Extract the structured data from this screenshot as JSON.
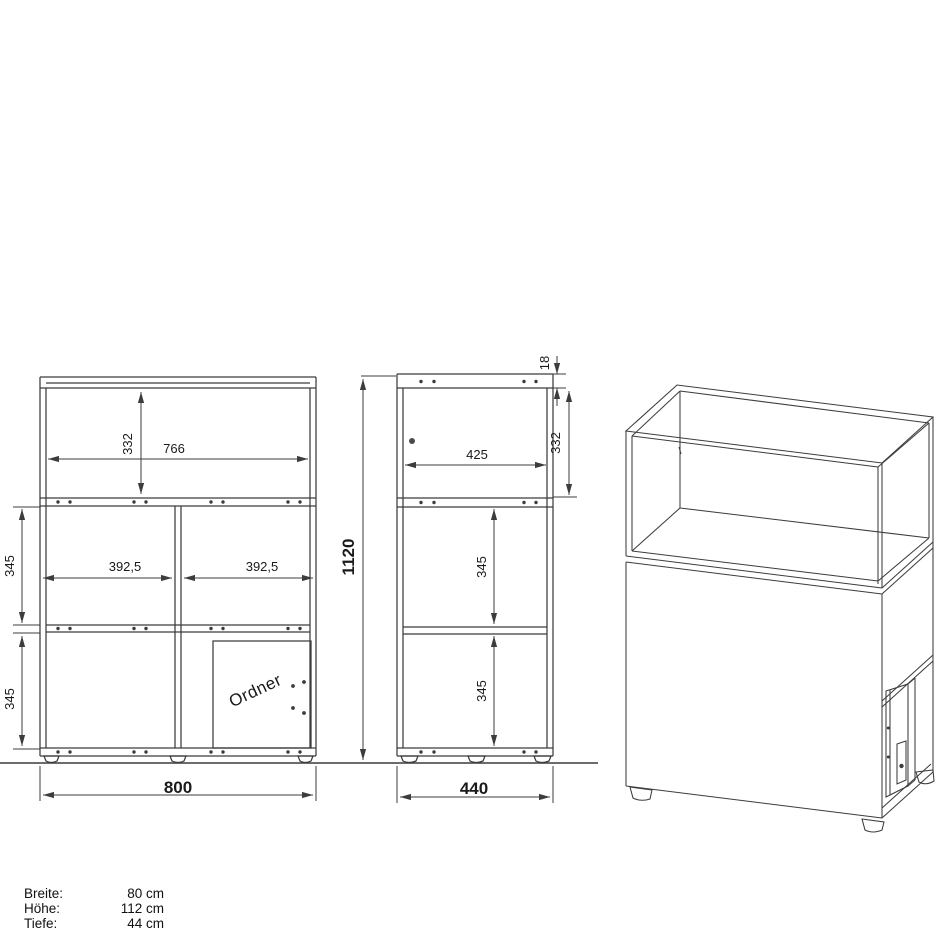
{
  "document": {
    "type": "furniture-technical-drawing",
    "background": "#ffffff",
    "line_color": "#3c3c3c",
    "text_color": "#1a1a1a"
  },
  "front_view": {
    "name": "front view",
    "dims": {
      "inner_height_top": "332",
      "inner_width_top": "766",
      "left_compartment_width": "392,5",
      "right_compartment_width": "392,5",
      "middle_section_height": "345",
      "bottom_section_height": "345",
      "overall_width": "800"
    },
    "door_label": "Ordner"
  },
  "side_view": {
    "name": "side view",
    "dims": {
      "top_panel_thickness": "18",
      "inner_height_top": "332",
      "inner_depth_top": "425",
      "middle_section_height": "345",
      "bottom_section_height": "345",
      "overall_height": "1120",
      "overall_depth": "440"
    }
  },
  "perspective_view": {
    "name": "3d-perspective-view"
  },
  "specs": {
    "rows": [
      {
        "label": "Breite:",
        "value": "80 cm"
      },
      {
        "label": "Höhe:",
        "value": "112 cm"
      },
      {
        "label": "Tiefe:",
        "value": "44 cm"
      }
    ]
  }
}
